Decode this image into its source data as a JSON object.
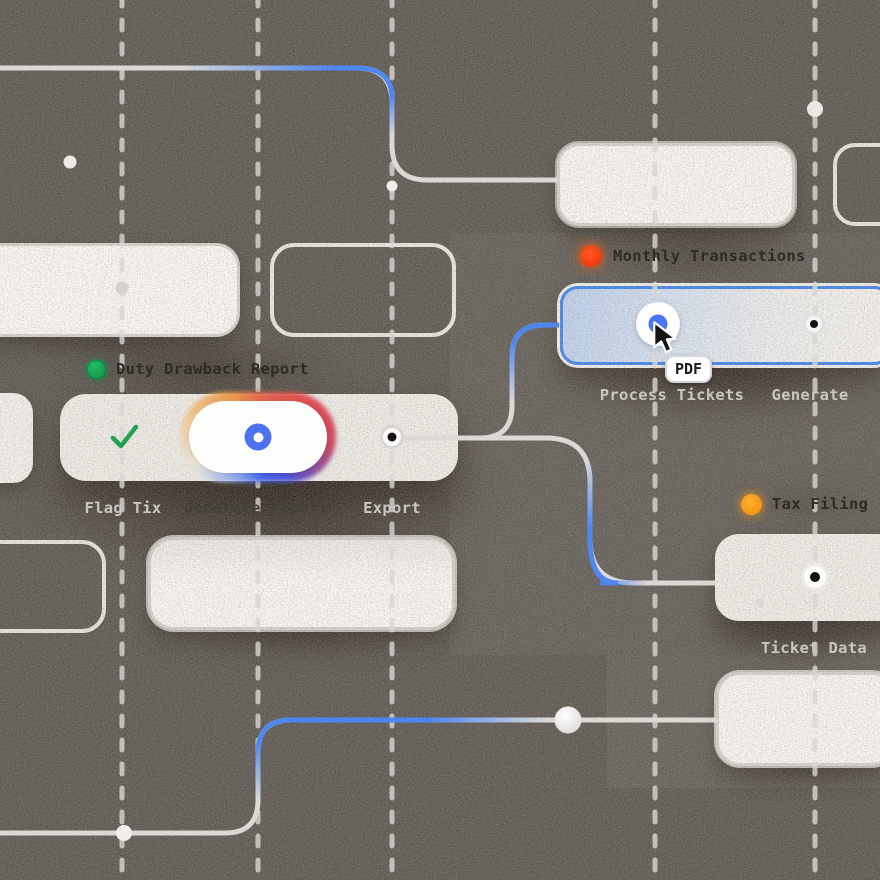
{
  "app": {
    "view": "workflow-canvas",
    "background_color": "#585450",
    "accent_blue": "#3f83f3",
    "wire_color": "#d9d7d4",
    "grid_dashed_line_xs": [
      122,
      258,
      392,
      655,
      815
    ]
  },
  "nodes": {
    "duty": {
      "title": "Duty Drawback Report",
      "status_color": "#16a24e",
      "port_labels": {
        "left": "Flag Tix",
        "center": "Generate Report",
        "right": "Export"
      }
    },
    "monthly": {
      "title": "Monthly Transactions",
      "status_color": "#f5380b",
      "selected": true,
      "tooltip": "PDF",
      "port_labels": {
        "left": "Process Tickets",
        "right": "Generate"
      }
    },
    "tax": {
      "title": "Tax Filing",
      "status_color": "#f59a12",
      "port_labels": {
        "center": "Ticket Data"
      }
    }
  }
}
